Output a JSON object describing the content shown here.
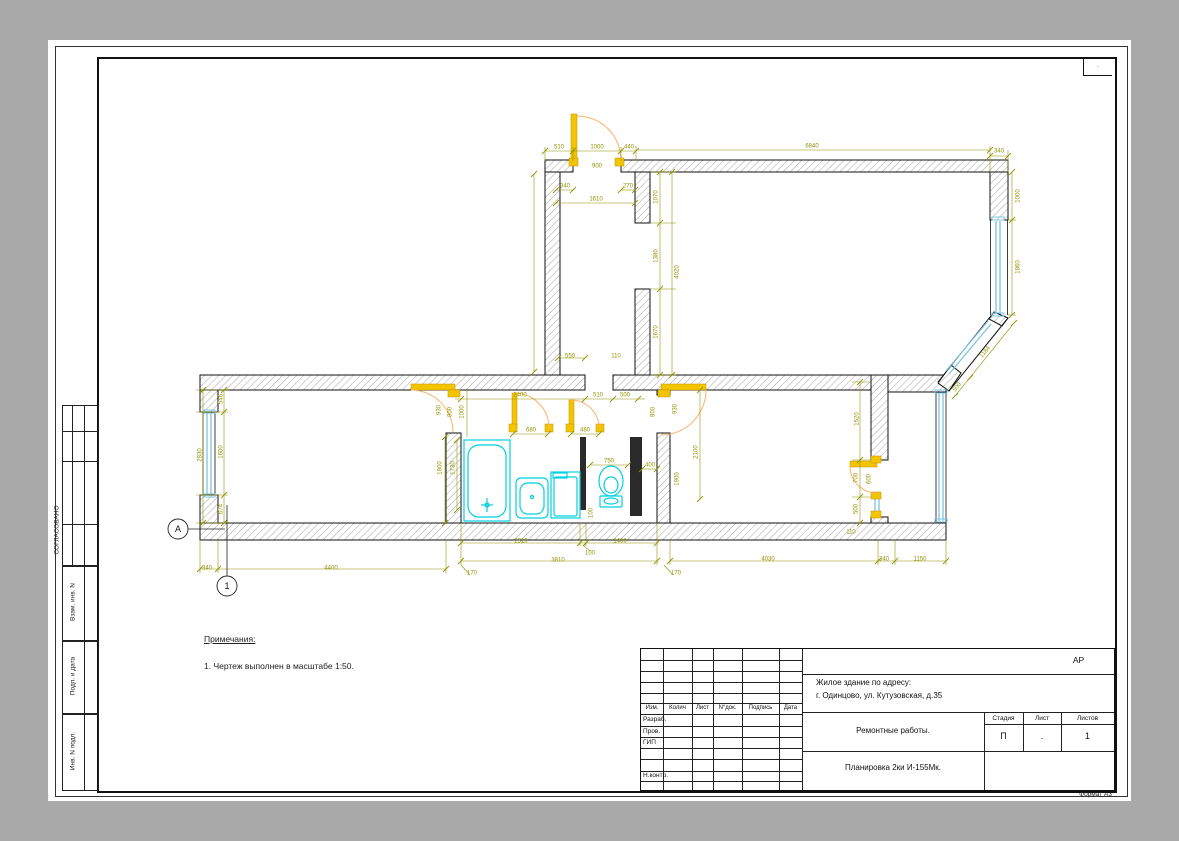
{
  "sheet": {
    "format_label": "Формат А3",
    "corner_dot": ".",
    "left_margin": {
      "approved": "СОГЛАСОВАНО",
      "vzam": "Взам. инв. N",
      "podp": "Подп. и дата",
      "inv": "Инв. N подл."
    },
    "notes": {
      "title": "Примечания:",
      "items": [
        "1. Чертеж выполнен в масштабе 1:50."
      ]
    }
  },
  "title_block": {
    "code": "АР",
    "object_line1": "Жилое здание по адресу:",
    "object_line2": "г. Одинцово, ул. Кутузовская, д.35",
    "work": "Ремонтные работы.",
    "sheet_name": "Планировка 2ки И-155Мк.",
    "cols": {
      "izm": "Изм.",
      "kol": "Колич",
      "list": "Лист",
      "ndok": "N°док.",
      "podpis": "Подпись",
      "data": "Дата"
    },
    "rows": {
      "razrab": "Разраб.",
      "prov": "Пров.",
      "gip": "ГИП",
      "nkontr": "Н.контр."
    },
    "stage": {
      "label": "Стадия",
      "value": "П"
    },
    "sheet_no": {
      "label": "Лист",
      "value": "."
    },
    "sheets": {
      "label": "Листов",
      "value": "1"
    }
  },
  "plan": {
    "axes": [
      {
        "label": "А",
        "x": 178,
        "y": 529
      },
      {
        "label": "1",
        "x": 227,
        "y": 586
      }
    ],
    "dimensions": [
      {
        "t": "510",
        "x": 559,
        "y": 147,
        "r": 0
      },
      {
        "t": "1000",
        "x": 597,
        "y": 147,
        "r": 0
      },
      {
        "t": "440",
        "x": 629,
        "y": 147,
        "r": 0
      },
      {
        "t": "6840",
        "x": 812,
        "y": 146,
        "r": 0
      },
      {
        "t": "340",
        "x": 999,
        "y": 151,
        "r": 0
      },
      {
        "t": "900",
        "x": 597,
        "y": 166,
        "r": 0
      },
      {
        "t": "340",
        "x": 565,
        "y": 186,
        "r": 0
      },
      {
        "t": "270",
        "x": 628,
        "y": 186,
        "r": 0
      },
      {
        "t": "1610",
        "x": 596,
        "y": 199,
        "r": 0
      },
      {
        "t": "1070",
        "x": 656,
        "y": 197,
        "r": -90
      },
      {
        "t": "1380",
        "x": 656,
        "y": 256,
        "r": -90
      },
      {
        "t": "1670",
        "x": 656,
        "y": 332,
        "r": -90
      },
      {
        "t": "4020",
        "x": 677,
        "y": 272,
        "r": -90
      },
      {
        "t": "1000",
        "x": 1018,
        "y": 196,
        "r": -90
      },
      {
        "t": "1860",
        "x": 1018,
        "y": 267,
        "r": -90
      },
      {
        "t": "1184",
        "x": 985,
        "y": 352,
        "r": -51
      },
      {
        "t": "500",
        "x": 957,
        "y": 387,
        "r": -51
      },
      {
        "t": "550",
        "x": 570,
        "y": 356,
        "r": 0
      },
      {
        "t": "110",
        "x": 616,
        "y": 356,
        "r": 0
      },
      {
        "t": "2400",
        "x": 520,
        "y": 395,
        "r": 0
      },
      {
        "t": "510",
        "x": 598,
        "y": 395,
        "r": 0
      },
      {
        "t": "500",
        "x": 625,
        "y": 395,
        "r": 0
      },
      {
        "t": "930",
        "x": 439,
        "y": 410,
        "r": -90
      },
      {
        "t": "800",
        "x": 450,
        "y": 412,
        "r": -90
      },
      {
        "t": "1000",
        "x": 462,
        "y": 412,
        "r": -90
      },
      {
        "t": "800",
        "x": 653,
        "y": 412,
        "r": -90
      },
      {
        "t": "930",
        "x": 675,
        "y": 409,
        "r": -90
      },
      {
        "t": "680",
        "x": 531,
        "y": 430,
        "r": 0
      },
      {
        "t": "480",
        "x": 585,
        "y": 430,
        "r": 0
      },
      {
        "t": "2100",
        "x": 696,
        "y": 452,
        "r": -90
      },
      {
        "t": "1900",
        "x": 677,
        "y": 479,
        "r": -90
      },
      {
        "t": "1800",
        "x": 440,
        "y": 468,
        "r": -90
      },
      {
        "t": "1730",
        "x": 453,
        "y": 468,
        "r": -90
      },
      {
        "t": "750",
        "x": 609,
        "y": 461,
        "r": 0
      },
      {
        "t": "400",
        "x": 650,
        "y": 465,
        "r": 0
      },
      {
        "t": "100",
        "x": 591,
        "y": 513,
        "r": -90
      },
      {
        "t": "546",
        "x": 221,
        "y": 399,
        "r": -90
      },
      {
        "t": "1600",
        "x": 221,
        "y": 452,
        "r": -90
      },
      {
        "t": "674",
        "x": 221,
        "y": 509,
        "r": -90
      },
      {
        "t": "2830",
        "x": 200,
        "y": 455,
        "r": -90
      },
      {
        "t": "1520",
        "x": 857,
        "y": 419,
        "r": -90
      },
      {
        "t": "700",
        "x": 856,
        "y": 478,
        "r": -90
      },
      {
        "t": "600",
        "x": 869,
        "y": 479,
        "r": -90
      },
      {
        "t": "500",
        "x": 856,
        "y": 509,
        "r": -90
      },
      {
        "t": "110",
        "x": 851,
        "y": 532,
        "r": 0
      },
      {
        "t": "2310",
        "x": 521,
        "y": 541,
        "r": 0
      },
      {
        "t": "100",
        "x": 590,
        "y": 553,
        "r": 0
      },
      {
        "t": "1400",
        "x": 620,
        "y": 541,
        "r": 0
      },
      {
        "t": "3810",
        "x": 558,
        "y": 560,
        "r": 0
      },
      {
        "t": "4030",
        "x": 768,
        "y": 559,
        "r": 0
      },
      {
        "t": "340",
        "x": 884,
        "y": 559,
        "r": 0
      },
      {
        "t": "1150",
        "x": 920,
        "y": 559,
        "r": 0
      },
      {
        "t": "340",
        "x": 207,
        "y": 568,
        "r": 0
      },
      {
        "t": "4400",
        "x": 331,
        "y": 568,
        "r": 0
      },
      {
        "t": "170",
        "x": 472,
        "y": 573,
        "r": 0
      },
      {
        "t": "170",
        "x": 676,
        "y": 573,
        "r": 0
      }
    ]
  },
  "colors": {
    "background": "#a9a9a9",
    "paper": "#ffffff",
    "line": "#111111",
    "dimension": "#8f9400",
    "door": "#f2c500",
    "door_arc": "#ffb066",
    "window": "#7fc4e0",
    "fixture": "#00d0e0"
  }
}
